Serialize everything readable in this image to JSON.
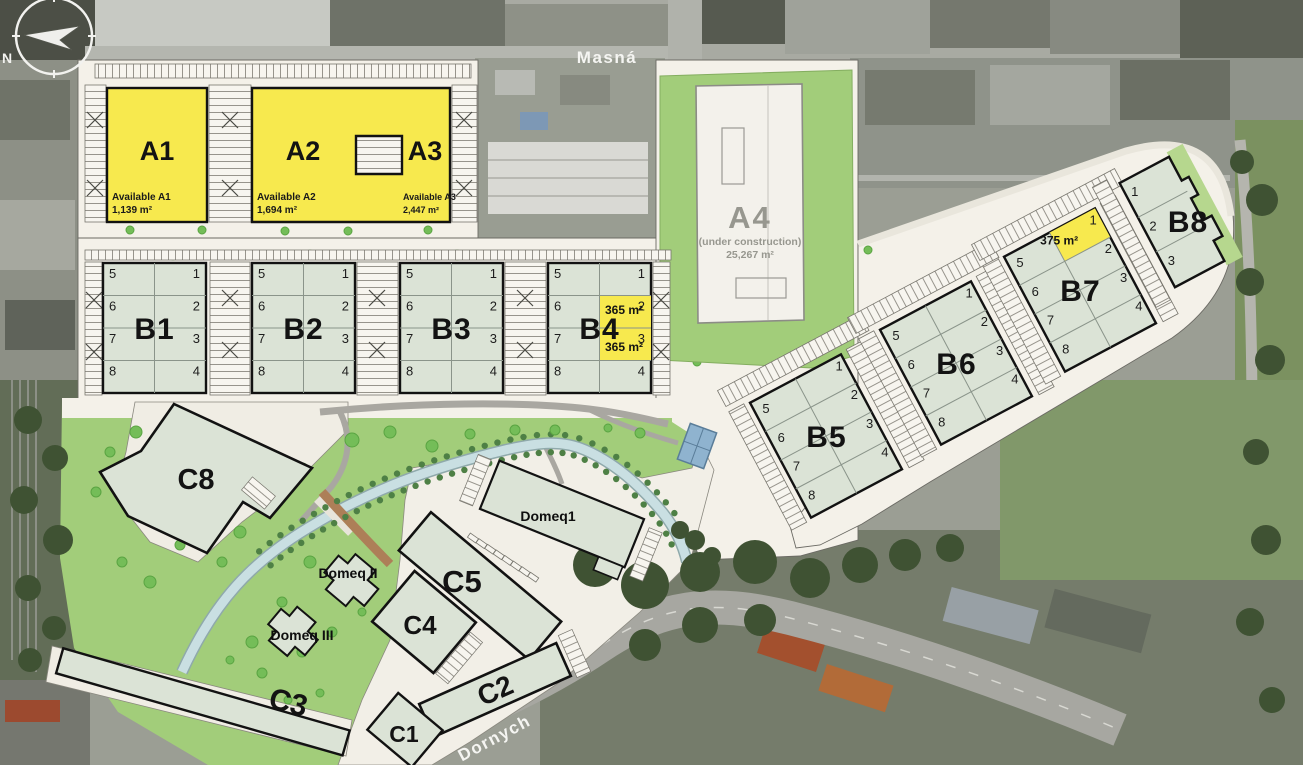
{
  "streets": {
    "top": "Masná",
    "bottom": "Dornych"
  },
  "compass": {
    "north_label": "N"
  },
  "colors": {
    "available_yellow": "#f7e94e",
    "building_green": "#dbe3d6",
    "park_green": "#a2cd7a",
    "plan_cream": "#f4f1e9",
    "canal_blue": "#c9dfe2"
  },
  "buildings": {
    "a1": {
      "label": "A1",
      "availability_label": "Available A1",
      "available_area": "1,139 m²"
    },
    "a2": {
      "label": "A2",
      "availability_label": "Available A2",
      "available_area": "1,694 m²"
    },
    "a3": {
      "label": "A3",
      "availability_label": "Available A3",
      "available_area": "2,447 m²"
    },
    "a4": {
      "label": "A4",
      "status": "(under construction)",
      "total_area": "25,267 m²"
    },
    "b1": {
      "label": "B1",
      "units": [
        "1",
        "2",
        "3",
        "4",
        "5",
        "6",
        "7",
        "8"
      ]
    },
    "b2": {
      "label": "B2",
      "units": [
        "1",
        "2",
        "3",
        "4",
        "5",
        "6",
        "7",
        "8"
      ]
    },
    "b3": {
      "label": "B3",
      "units": [
        "1",
        "2",
        "3",
        "4",
        "5",
        "6",
        "7",
        "8"
      ]
    },
    "b4": {
      "label": "B4",
      "units": [
        "1",
        "2",
        "3",
        "4",
        "5",
        "6",
        "7",
        "8"
      ],
      "highlighted_units": [
        {
          "unit": "2",
          "area": "365 m²"
        },
        {
          "unit": "3",
          "area": "365 m²"
        }
      ]
    },
    "b5": {
      "label": "B5",
      "units": [
        "1",
        "2",
        "3",
        "4",
        "5",
        "6",
        "7",
        "8"
      ]
    },
    "b6": {
      "label": "B6",
      "units": [
        "1",
        "2",
        "3",
        "4",
        "5",
        "6",
        "7",
        "8"
      ]
    },
    "b7": {
      "label": "B7",
      "units": [
        "1",
        "2",
        "3",
        "4",
        "5",
        "6",
        "7",
        "8"
      ],
      "highlighted_units": [
        {
          "unit": "1",
          "area": "375 m²"
        }
      ]
    },
    "b8": {
      "label": "B8",
      "units": [
        "1",
        "2",
        "3"
      ]
    },
    "c1": {
      "label": "C1"
    },
    "c2": {
      "label": "C2"
    },
    "c3": {
      "label": "C3"
    },
    "c4": {
      "label": "C4"
    },
    "c5": {
      "label": "C5"
    },
    "c8": {
      "label": "C8"
    },
    "domeq1": {
      "label": "Domeq1"
    },
    "domeq2": {
      "label": "Domeq II"
    },
    "domeq3": {
      "label": "Domeq III"
    }
  }
}
